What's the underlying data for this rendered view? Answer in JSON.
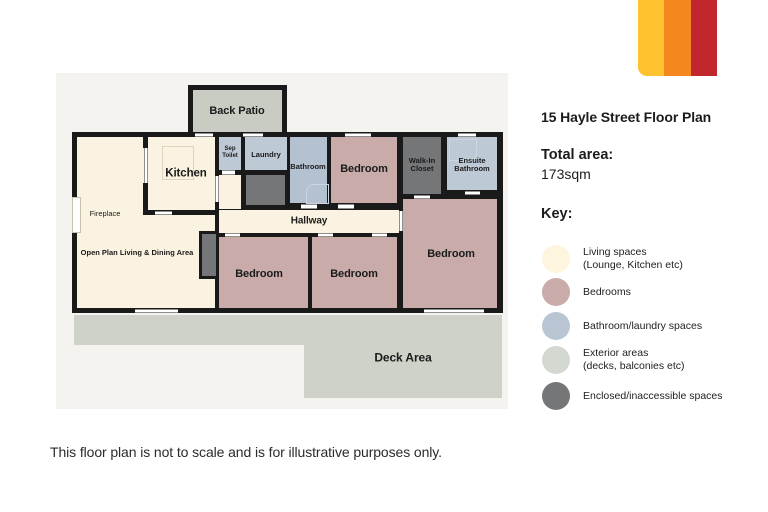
{
  "logo": {
    "stripes": [
      {
        "name": "yellow",
        "color": "#fdc22d"
      },
      {
        "name": "orange",
        "color": "#f5871f"
      },
      {
        "name": "red",
        "color": "#c1272d"
      }
    ]
  },
  "panel": {
    "title": "15 Hayle Street Floor Plan",
    "total_area": {
      "label": "Total area:",
      "value": "173sqm"
    },
    "key_label": "Key:",
    "legend": [
      {
        "label": "Living spaces\n(Lounge, Kitchen etc)",
        "color": "#fdf5dd"
      },
      {
        "label": "Bedrooms",
        "color": "#c9abaa"
      },
      {
        "label": "Bathroom/laundry spaces",
        "color": "#b9c5d2"
      },
      {
        "label": "Exterior areas\n(decks, balconies etc)",
        "color": "#d3d8d0"
      },
      {
        "label": "Enclosed/inaccessible spaces",
        "color": "#757677"
      }
    ]
  },
  "floorplan": {
    "rooms": {
      "back_patio": "Back Patio",
      "kitchen": "Kitchen",
      "sep_toilet": "Sep\nToilet",
      "laundry": "Laundry",
      "bathroom": "Bathroom",
      "bedroom_top": "Bedroom",
      "walk_in_closet": "Walk-In\nCloset",
      "ensuite_bathroom": "Ensuite\nBathroom",
      "hallway": "Hallway",
      "bedroom_left": "Bedroom",
      "bedroom_middle": "Bedroom",
      "bedroom_right": "Bedroom",
      "living": "Open Plan Living & Dining Area",
      "fireplace": "Fireplace",
      "deck": "Deck Area"
    },
    "colors": {
      "wall": "#1a1a1a",
      "living_spaces": "#fbf3e1",
      "bedrooms": "#c9abaa",
      "bathroom_laundry": "#bdc9d5",
      "exterior": "#ced2c9",
      "enclosed": "#747678",
      "plan_background": "#f4f3f0"
    }
  },
  "disclaimer": "This floor plan is not to scale and is for illustrative purposes only."
}
